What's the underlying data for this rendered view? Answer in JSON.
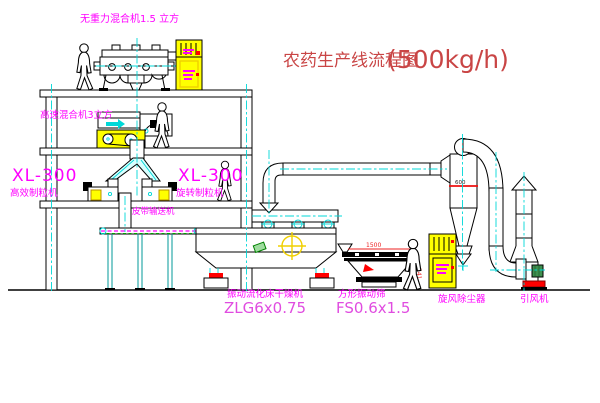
{
  "title": {
    "text_cn": "农药生产线流程图",
    "capacity": "(500kg/h)"
  },
  "equipment_labels": {
    "gravity_free_mixer": "无重力混合机1.5 立方",
    "high_speed_mixer": "高速混合机3立方",
    "granulator_left_model": "XL-300",
    "granulator_left_name": "高效制粒机",
    "granulator_right_model": "XL-300",
    "granulator_right_name": "旋转制粒机",
    "belt_conveyor": "皮带输送机",
    "fluid_bed_dryer_name": "振动流化床干燥机",
    "fluid_bed_dryer_model": "ZLG6x0.75",
    "vibrating_sieve_name": "方形振动筛",
    "vibrating_sieve_model": "FS0.6x1.5",
    "cyclone_dust_collector": "旋风除尘器",
    "induced_draft_fan": "引风机"
  },
  "dimensions": {
    "cyclone_diameter": "600",
    "sieve_length": "1500",
    "sieve_height": "541"
  },
  "colors": {
    "label_magenta": "#ff00ff",
    "model_magenta": "#e04ce0",
    "title_red": "#c94545",
    "equipment_yellow": "#ffff00",
    "centerline_cyan": "#00d8d8",
    "accent_red": "#ff0000",
    "line_black": "#000000"
  }
}
